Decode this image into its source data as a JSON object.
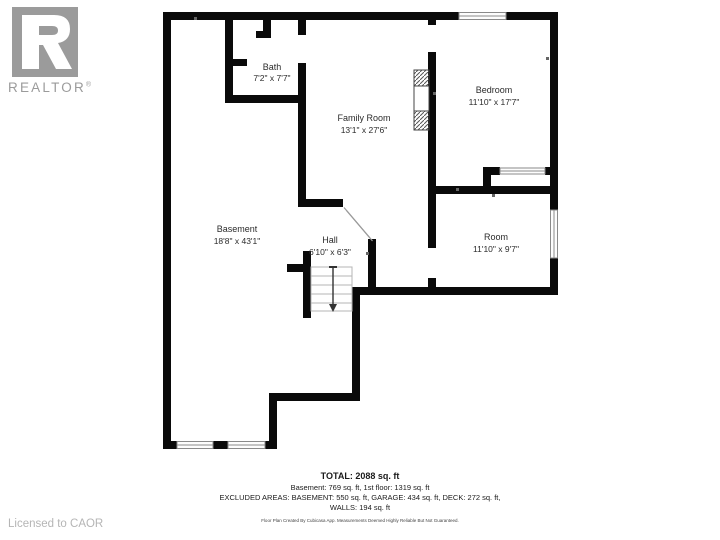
{
  "branding": {
    "logo_wordmark": "REALTOR",
    "logo_reg": "®",
    "license_text": "Licensed to CAOR"
  },
  "rooms": [
    {
      "name": "Bath",
      "dims": "7'2\" x 7'7\""
    },
    {
      "name": "Family Room",
      "dims": "13'1\" x 27'6\""
    },
    {
      "name": "Bedroom",
      "dims": "11'10\" x 17'7\""
    },
    {
      "name": "Basement",
      "dims": "18'8\" x 43'1\""
    },
    {
      "name": "Hall",
      "dims": "6'10\" x 6'3\""
    },
    {
      "name": "Room",
      "dims": "11'10\" x 9'7\""
    }
  ],
  "summary": {
    "total": "TOTAL: 2088 sq. ft",
    "floors": "Basement: 769 sq. ft, 1st floor: 1319 sq. ft",
    "excluded": "EXCLUDED AREAS: BASEMENT: 550 sq. ft, GARAGE: 434 sq. ft, DECK: 272 sq. ft,",
    "walls": "WALLS: 194 sq. ft",
    "disclaimer": "Floor Plan Created By Cubicasa App. Measurements Deemed Highly Reliable But Not Guaranteed."
  },
  "colors": {
    "wall": "#0a0a0a",
    "logo_gray": "#9b9b9b",
    "license_gray": "#b5b5b5",
    "label_text": "#2b2b2b"
  }
}
